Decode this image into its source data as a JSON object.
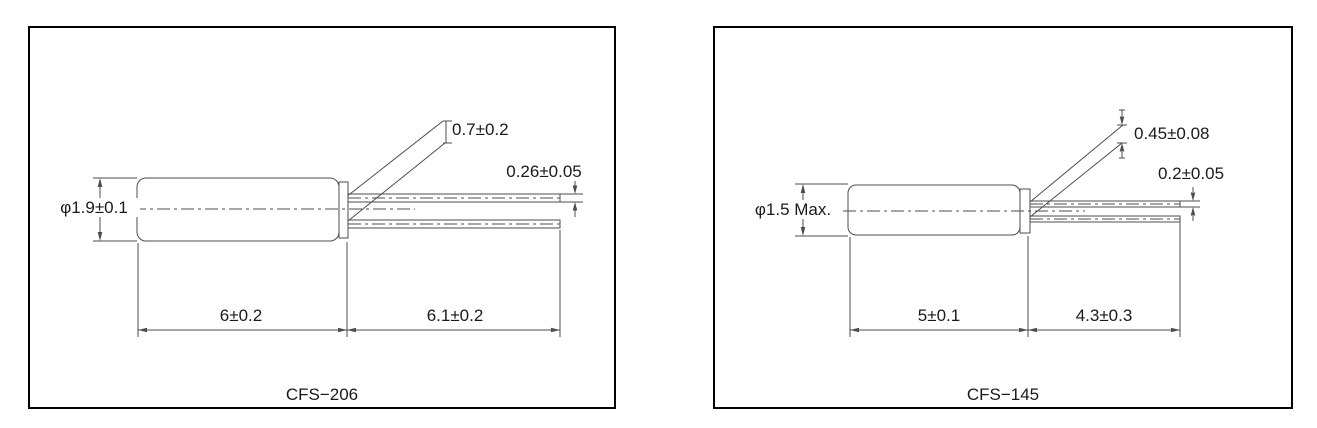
{
  "colors": {
    "line": "#4d4d4d",
    "border": "#000000",
    "text": "#1a1a1a",
    "background": "#ffffff"
  },
  "panels": [
    {
      "model": "CFS−206",
      "dims": {
        "diameter": "φ1.9±0.1",
        "body_length": "6±0.2",
        "lead_length": "6.1±0.2",
        "lead_tip_spacing": "0.7±0.2",
        "lead_diameter": "0.26±0.05"
      }
    },
    {
      "model": "CFS−145",
      "dims": {
        "diameter": "φ1.5 Max.",
        "body_length": "5±0.1",
        "lead_length": "4.3±0.3",
        "lead_tip_spacing": "0.45±0.08",
        "lead_diameter": "0.2±0.05"
      }
    }
  ]
}
